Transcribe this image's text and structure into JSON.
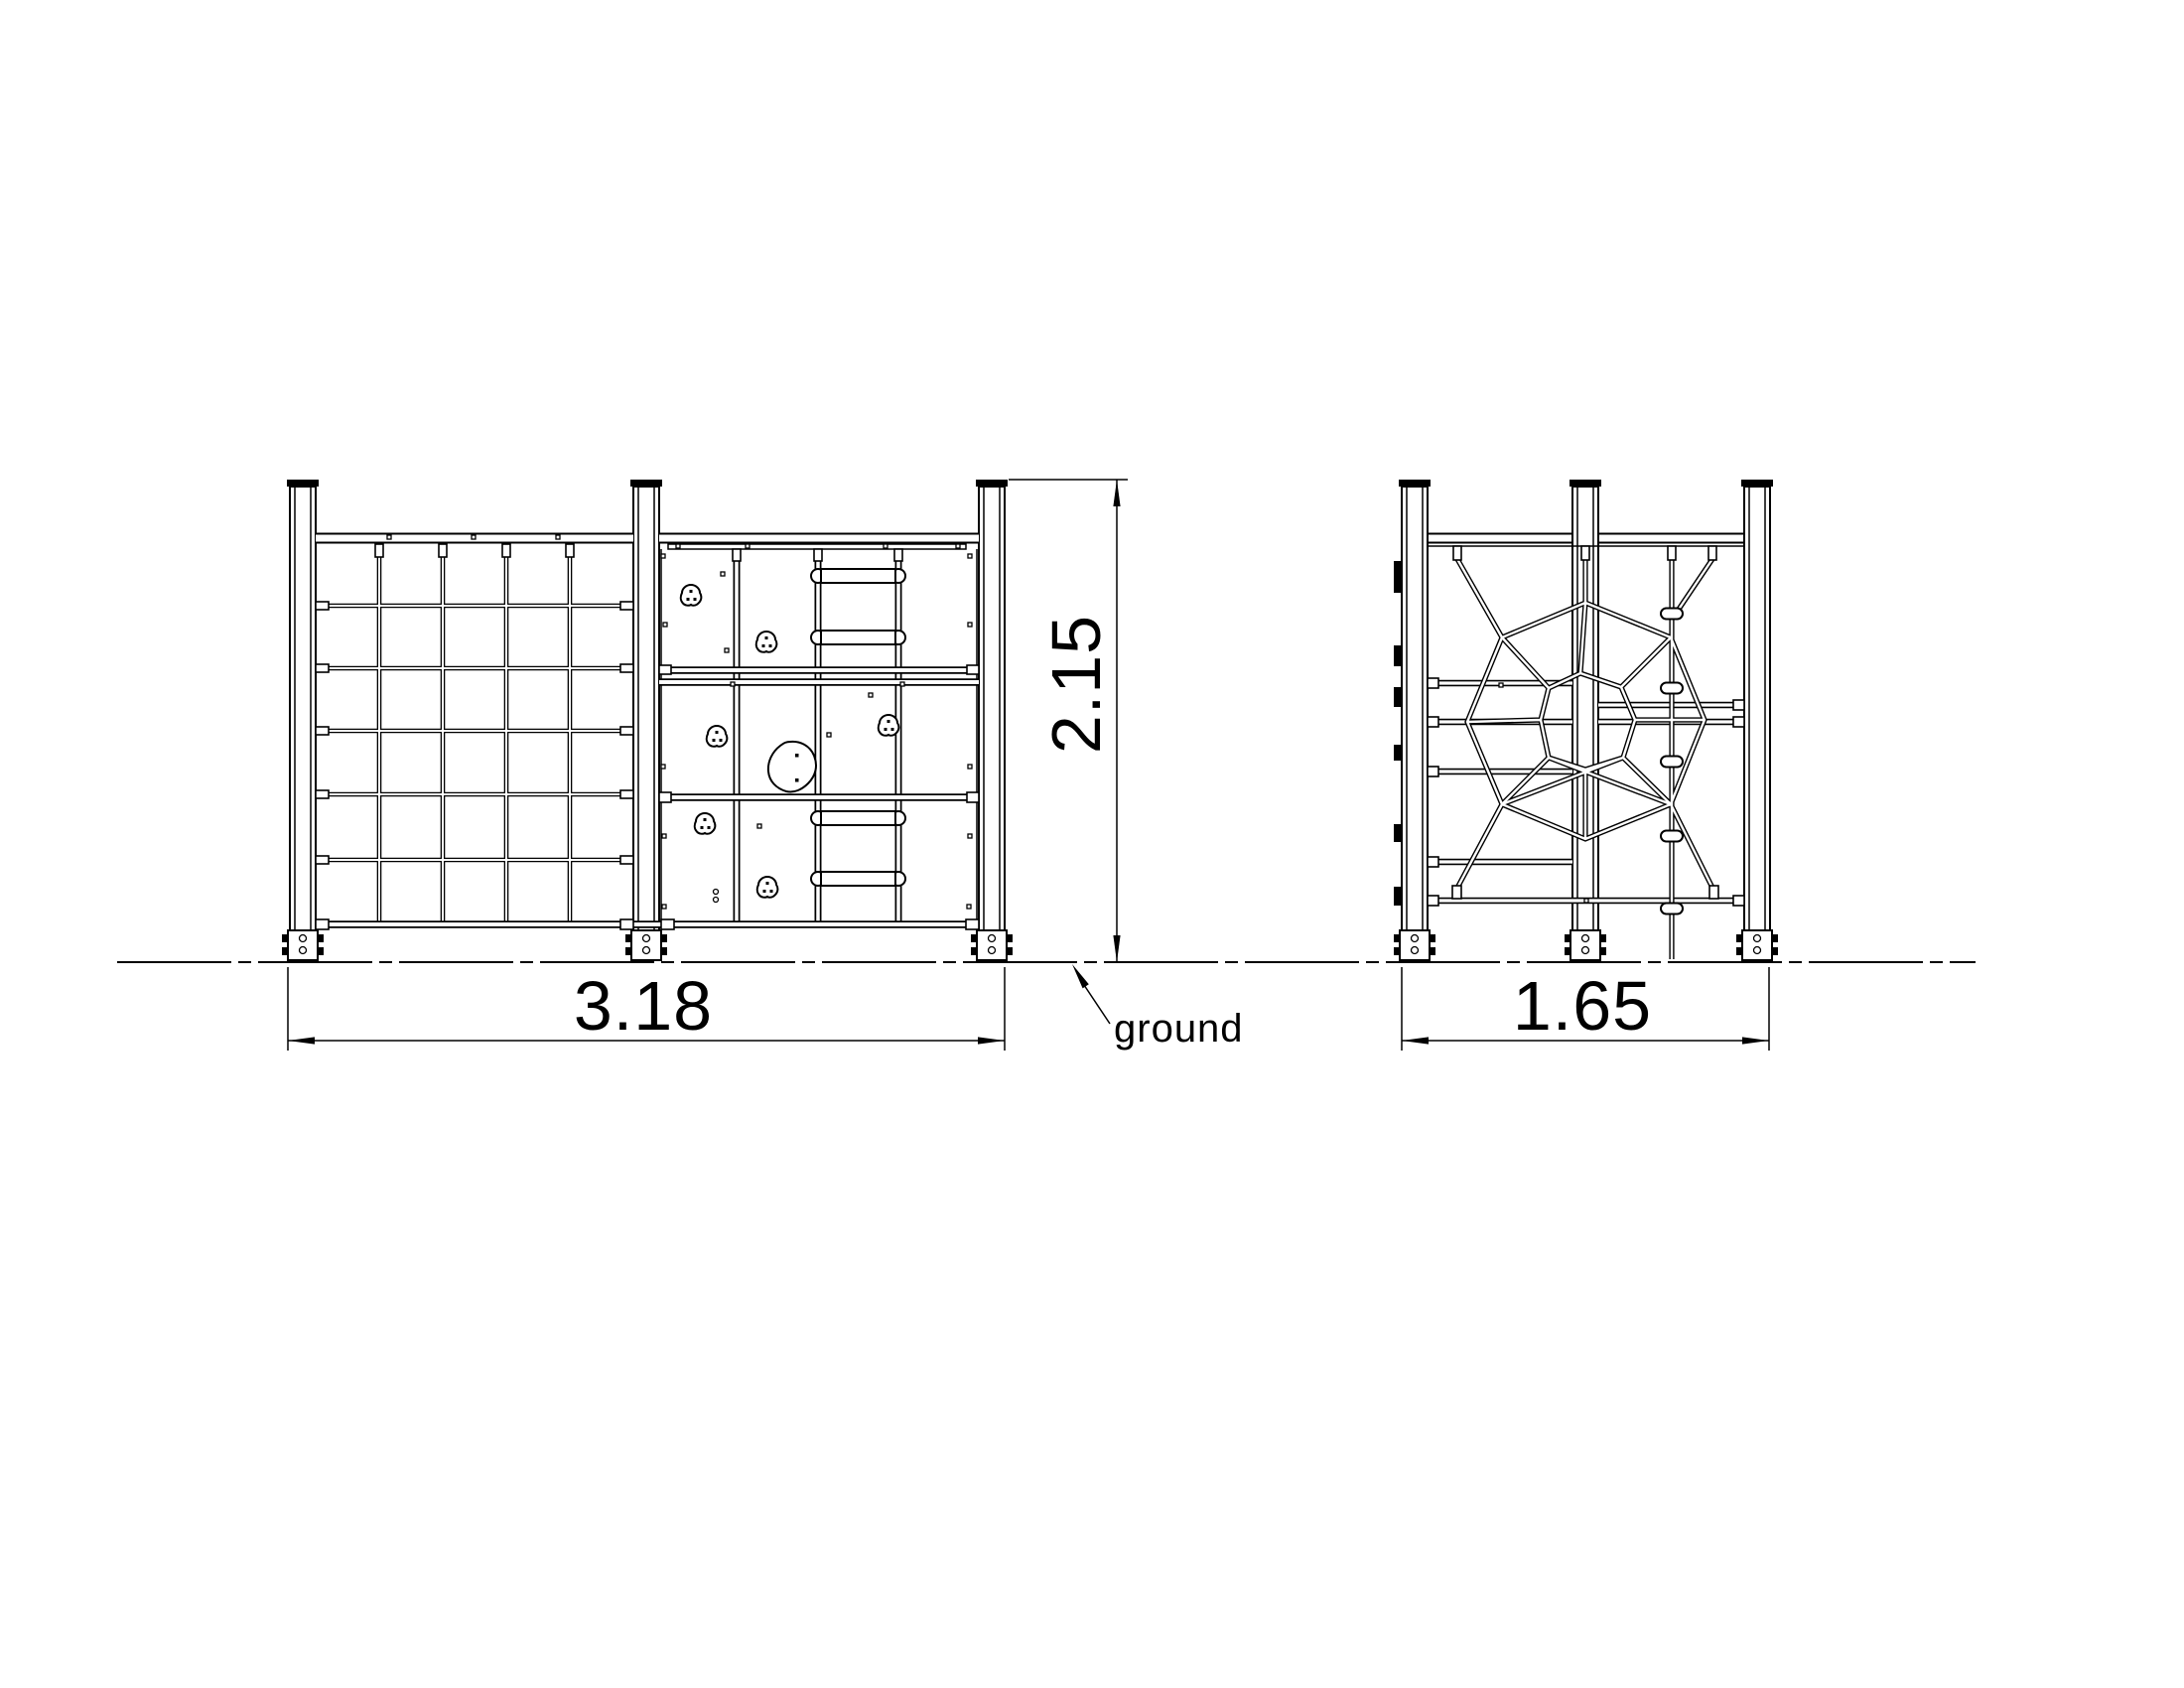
{
  "colors": {
    "background": "#ffffff",
    "line": "#000000"
  },
  "annotations": {
    "front_width": "3.18",
    "height": "2.15",
    "side_width": "1.65",
    "ground_label": "ground"
  }
}
